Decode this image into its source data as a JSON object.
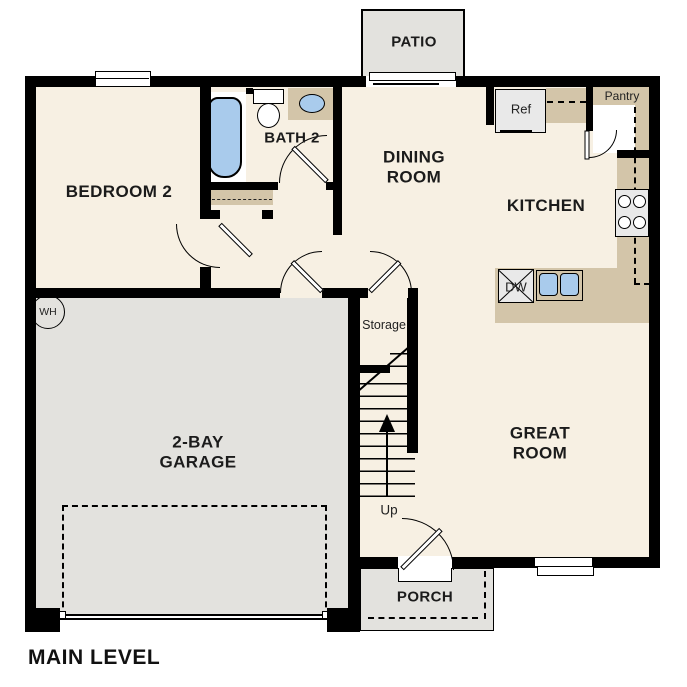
{
  "plan_title": "MAIN LEVEL",
  "rooms": {
    "patio": "PATIO",
    "bedroom2": "BEDROOM 2",
    "bath2": "BATH 2",
    "dining1": "DINING",
    "dining2": "ROOM",
    "kitchen": "KITCHEN",
    "great1": "GREAT",
    "great2": "ROOM",
    "garage1": "2-BAY",
    "garage2": "GARAGE",
    "porch": "PORCH",
    "storage": "Storage"
  },
  "fixtures": {
    "ref": "Ref",
    "pantry": "Pantry",
    "dishwasher": "DW",
    "water_heater": "WH",
    "stairs_direction": "Up"
  },
  "colors": {
    "wall": "#000000",
    "floor": "#f7f0e3",
    "hardscape": "#e3e2de",
    "counter": "#d3c5a9",
    "fixture_blue": "#a9cbec",
    "appliance": "#e9e9e9"
  }
}
